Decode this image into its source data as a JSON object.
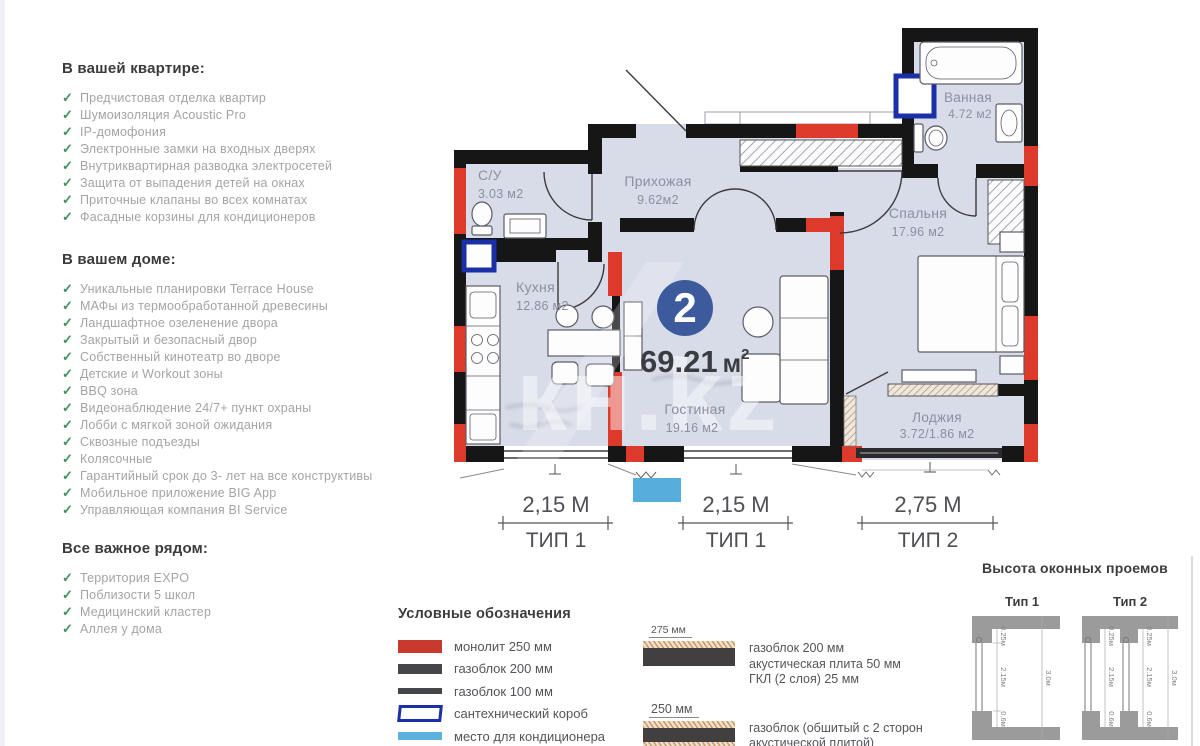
{
  "icons": {
    "check": "✓"
  },
  "sidebar": {
    "sections": [
      {
        "title": "В вашей квартире:",
        "items": [
          "Предчистовая отделка квартир",
          "Шумоизоляция Acoustic Pro",
          "IP-домофония",
          "Электронные замки на входных дверях",
          "Внутриквартирная разводка электросетей",
          "Защита от выпадения детей на окнах",
          "Приточные клапаны во всех комнатах",
          "Фасадные корзины для кондиционеров"
        ]
      },
      {
        "title": "В вашем доме:",
        "items": [
          "Уникальные планировки Terrace House",
          "МАФы из термообработанной древесины",
          "Ландшафтное озеленение двора",
          "Закрытый и безопасный двор",
          "Собственный кинотеатр во дворе",
          "Детские и Workout зоны",
          "BBQ зона",
          "Видеонаблюдение 24/7+ пункт охраны",
          "Лобби с мягкой зоной ожидания",
          "Сквозные подъезды",
          "Колясочные",
          "Гарантийный срок до 3- лет на все конструктивы",
          "Мобильное приложение BIG App",
          "Управляющая компания BI Service"
        ]
      },
      {
        "title": "Все важное рядом:",
        "items": [
          "Территория EXPO",
          "Поблизости 5 школ",
          "Медицинский кластер",
          "Аллея у дома"
        ]
      }
    ]
  },
  "plan": {
    "rooms": {
      "su": {
        "name": "С/У",
        "area": "3.03 м2"
      },
      "hallway": {
        "name": "Прихожая",
        "area": "9.62м2"
      },
      "bathroom": {
        "name": "Ванная",
        "area": "4.72 м2"
      },
      "bedroom": {
        "name": "Спальня",
        "area": "17.96 м2"
      },
      "kitchen": {
        "name": "Кухня",
        "area": "12.86 м2"
      },
      "living": {
        "name": "Гостиная",
        "area": "19.16 м2"
      },
      "loggia": {
        "name": "Лоджия",
        "area": "3.72/1.86 м2"
      }
    },
    "badge_number": "2",
    "area_value": "69.21",
    "area_unit": "м",
    "area_sup": "2",
    "watermark": "кн.kz",
    "dimensions": [
      {
        "length": "2,15 М",
        "type": "ТИП 1"
      },
      {
        "length": "2,15 М",
        "type": "ТИП 1"
      },
      {
        "length": "2,75 М",
        "type": "ТИП 2"
      }
    ]
  },
  "legend": {
    "title": "Условные обозначения",
    "items": [
      {
        "label": "монолит 250 мм"
      },
      {
        "label": "газоблок 200 мм"
      },
      {
        "label": "газоблок 100 мм"
      },
      {
        "label": "сантехнический короб"
      },
      {
        "label": "место для кондиционера"
      }
    ],
    "wall_types": [
      {
        "size": "275 мм",
        "lines": [
          "газоблок 200 мм",
          "акустическая плита 50 мм",
          "ГКЛ (2 слоя) 25 мм"
        ]
      },
      {
        "size": "250 мм",
        "lines": [
          "газоблок (обшитый с 2 сторон",
          "акустической плитой)",
          "ГКЛ ( 2 слоя)"
        ]
      }
    ]
  },
  "window_heights": {
    "title": "Высота оконных проемов",
    "types": [
      {
        "label": "Тип 1",
        "dims": [
          "0.25м",
          "2.15м",
          "0.6м",
          "3.0м"
        ]
      },
      {
        "label": "Тип 2",
        "dims": [
          "0.25м",
          "2.15м",
          "0.6м",
          "3.0м"
        ]
      }
    ]
  },
  "colors": {
    "monolith": "#dd3a2c",
    "gasblock": "#45464a",
    "plumbing_box": "#1b2fa8",
    "ac_place": "#57aedd",
    "badge": "#3d5b9c",
    "floor": "#d8dbe8"
  }
}
